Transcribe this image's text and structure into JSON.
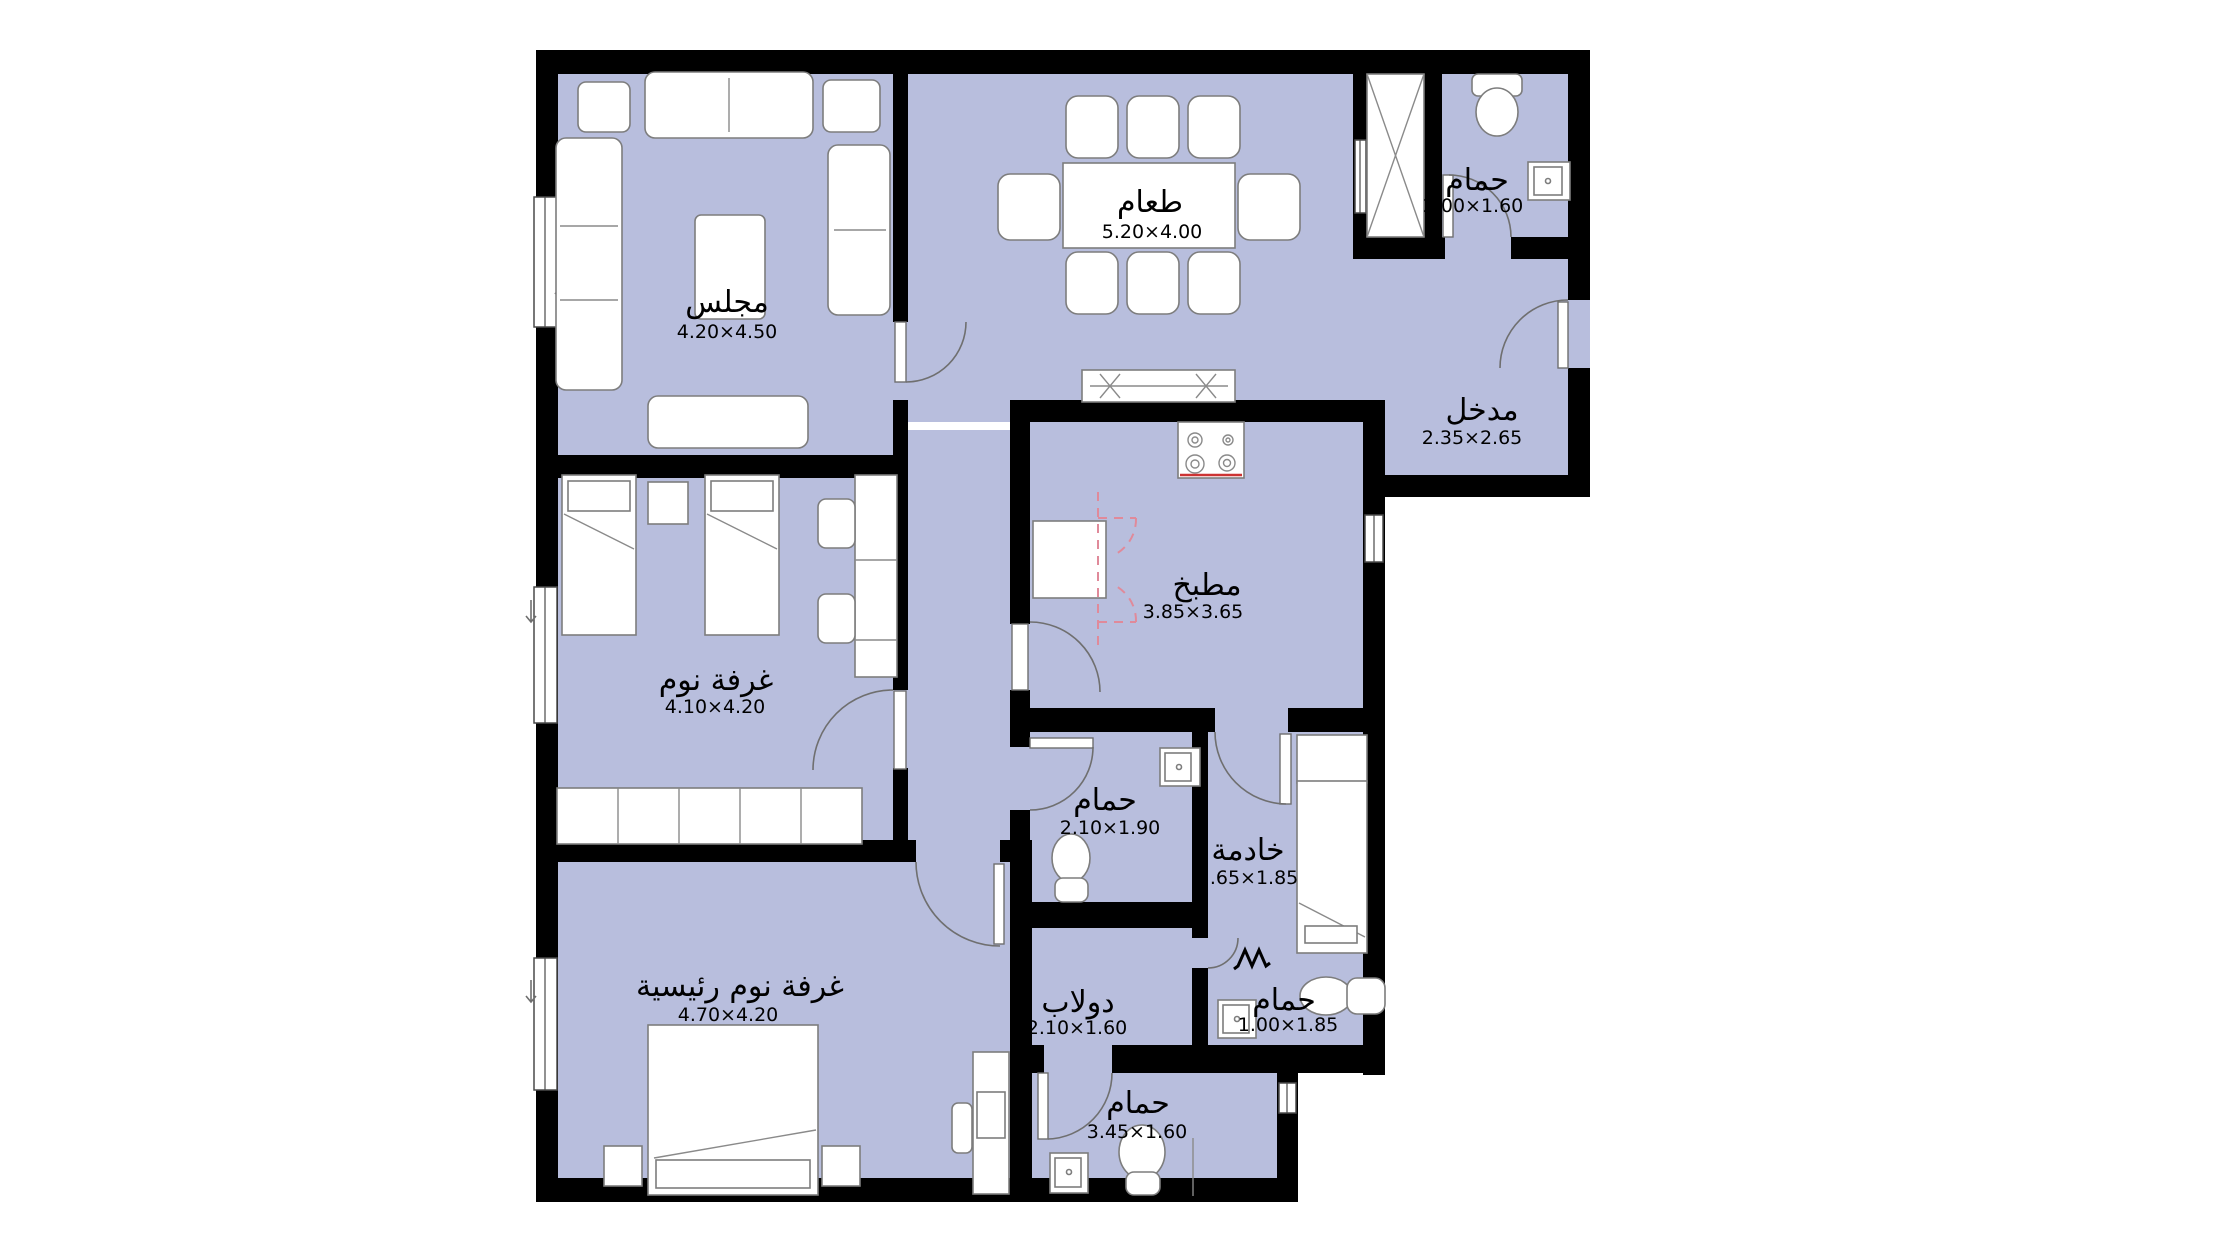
{
  "plan_title": "Apartment floor plan",
  "colors": {
    "floor_fill": "#b8bedd",
    "wall": "#000000",
    "furniture_outline": "#7d7d7d",
    "door_arc": "#6f6f6f",
    "kitchen_swing_dash": "#e08a9a",
    "stove_accent": "#cc3333",
    "background": "#ffffff"
  },
  "rooms": {
    "majlis": {
      "name": "مجلس",
      "dims": "4.20×4.50"
    },
    "dining": {
      "name": "طعام",
      "dims": "5.20×4.00"
    },
    "bath_top_right": {
      "name": "حمام",
      "dims": "2.00×1.60"
    },
    "entrance": {
      "name": "مدخل",
      "dims": "2.35×2.65"
    },
    "kitchen": {
      "name": "مطبخ",
      "dims": "3.85×3.65"
    },
    "bedroom": {
      "name": "غرفة نوم",
      "dims": "4.10×4.20"
    },
    "bath_middle": {
      "name": "حمام",
      "dims": "2.10×1.90"
    },
    "maid": {
      "name": "خادمة",
      "dims": "2.65×1.85"
    },
    "bath_small": {
      "name": "حمام",
      "dims": "1.00×1.85"
    },
    "closet": {
      "name": "دولاب",
      "dims": "2.10×1.60"
    },
    "master_bedroom": {
      "name": "غرفة نوم رئيسية",
      "dims": "4.70×4.20"
    },
    "bath_bottom": {
      "name": "حمام",
      "dims": "3.45×1.60"
    }
  }
}
